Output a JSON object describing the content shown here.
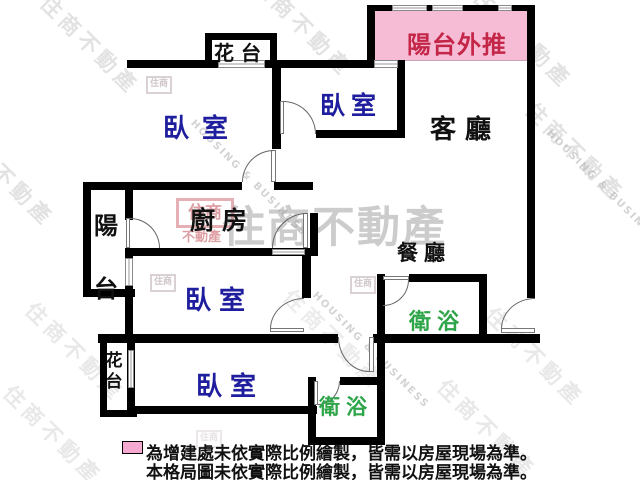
{
  "meta": {
    "type": "floor-plan"
  },
  "rooms": {
    "flower_bed_top": "花台",
    "balcony_extension": "陽台外推",
    "bedroom1": "臥室",
    "bedroom2": "臥室",
    "living_room": "客廳",
    "balcony": "陽台",
    "kitchen": "廚房",
    "dining_room": "餐廳",
    "bedroom3": "臥室",
    "bathroom1": "衛浴",
    "flower_bed_left": "花台",
    "bedroom4": "臥室",
    "bathroom2": "衛浴"
  },
  "legend": {
    "line1": "為增建處未依實際比例繪製，皆需以房屋現場為準。",
    "line2": "本格局圖未依實際比例繪製，皆需以房屋現場為準。"
  },
  "watermark": {
    "brand": "住商不動產",
    "brand_en": "HOUSING & BUSINESS",
    "logo_text": "住商",
    "logo_sub": "不動產"
  },
  "colors": {
    "wall": "#000000",
    "balcony_extension_fill": "#F6BBD5",
    "balcony_extension_text": "#C42647",
    "bedroom_text": "#1E1E9E",
    "bathroom_text": "#2FA54A",
    "legend_swatch": "#F6AAD2"
  }
}
